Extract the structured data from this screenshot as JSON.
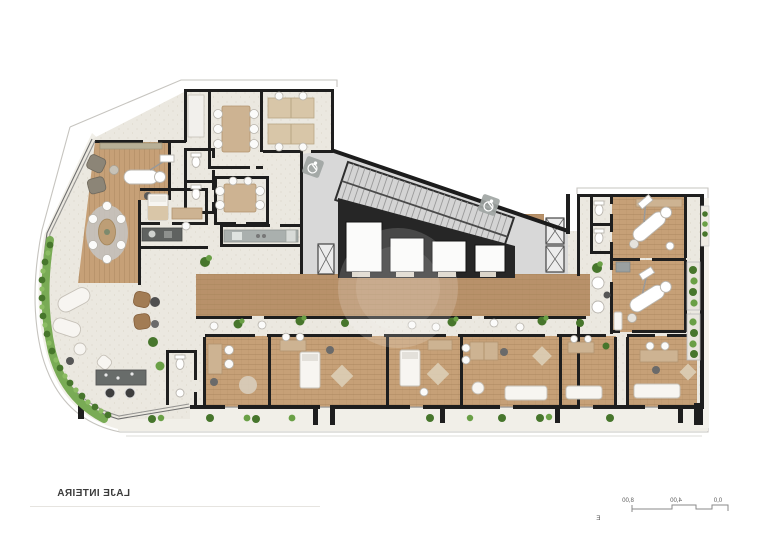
{
  "title": {
    "label": "LAJE INTEIRA",
    "mirrored": true
  },
  "scale_bar": {
    "caption": "Escala Gráfica",
    "mirrored": true,
    "tick_labels": [
      "0,0",
      "4,00",
      "8,00",
      "14,00",
      "24,00"
    ],
    "tick_meters": [
      0,
      4,
      8,
      14,
      24
    ]
  },
  "plan": {
    "type": "architectural-floor-plan",
    "orientation": "horizontally-mirrored",
    "inventory": {
      "elevators": 4,
      "staircases": 1,
      "accessible_badges": 2,
      "dental_chairs": 3,
      "meeting_rooms": 2,
      "consultation_rooms": 6
    },
    "icons": [
      "wheelchair-accessible-icon"
    ]
  },
  "colors": {
    "wall": "#1e1e1e",
    "wood": "#c6a077",
    "wood_dark": "#b8916a",
    "wood_line": "#a9855c",
    "tile": "#ebe8e0",
    "core_gray": "#d8d8d8",
    "stair_gray": "#d4d4d4",
    "furniture_tan": "#cdb392",
    "greenery": "#6aa046",
    "greenery_dark": "#47762c",
    "hedge": "#79ab55",
    "text": "#3c3c3c",
    "outline": "#c6c4bf"
  }
}
